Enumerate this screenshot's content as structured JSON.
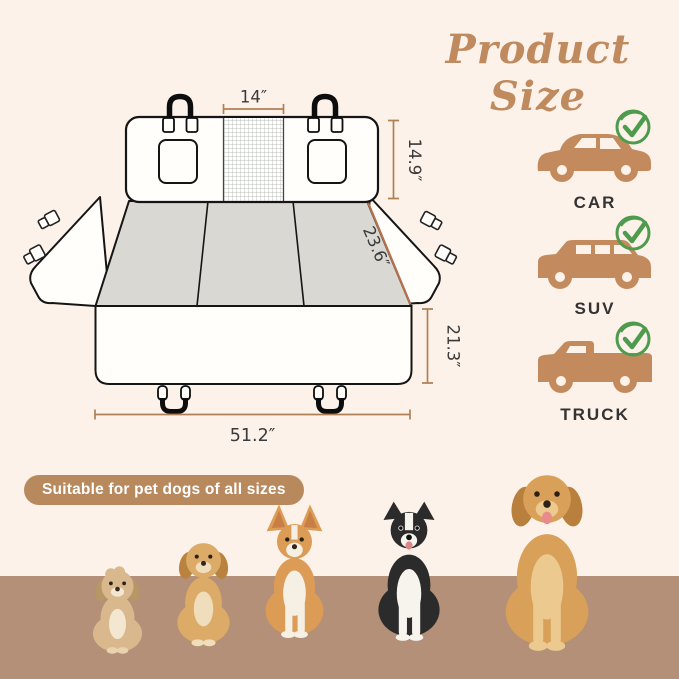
{
  "title": "Product Size",
  "diagram": {
    "dims": {
      "mesh_width": "14″",
      "back_height": "14.9″",
      "seat_depth": "23.6″",
      "front_height": "21.3″",
      "total_width": "51.2″"
    }
  },
  "vehicles": [
    {
      "label": "CAR",
      "icon": "car-icon",
      "status_icon": "check-icon"
    },
    {
      "label": "SUV",
      "icon": "suv-icon",
      "status_icon": "check-icon"
    },
    {
      "label": "TRUCK",
      "icon": "truck-icon",
      "status_icon": "check-icon"
    }
  ],
  "badge": {
    "text": "Suitable for pet dogs of all sizes"
  },
  "dogs": [
    "small-fluffy-puppy",
    "golden-puppy",
    "corgi",
    "border-collie",
    "golden-retriever"
  ],
  "colors": {
    "background": "#fdf2e9",
    "floor": "#b39077",
    "accent_tan": "#c38a5e",
    "badge": "#b9895e",
    "dimension_line": "#b08055",
    "seat_dimension_line": "#b5714c",
    "check_green": "#4e9b4e",
    "seat_gray": "#d9d8d2",
    "outline": "#151515",
    "title": "#c08a5f",
    "text_dark": "#3a3a3a"
  }
}
